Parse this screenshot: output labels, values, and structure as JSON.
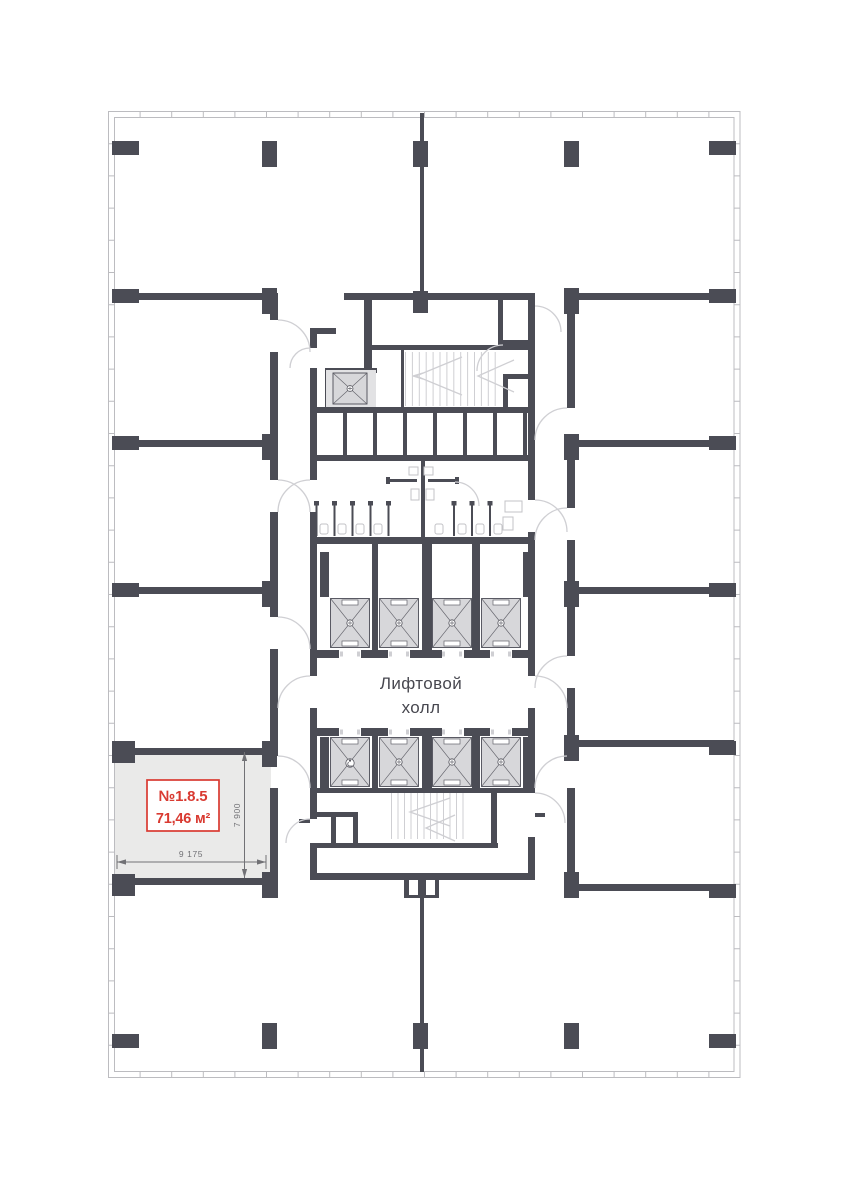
{
  "plan": {
    "elevator_hall": {
      "line1": "Лифтовой",
      "line2": "холл"
    },
    "unit": {
      "number": "№1.8.5",
      "area": "71,46 м²",
      "width_dim": "9 175",
      "height_dim": "7 900"
    }
  },
  "colors": {
    "wall": "#4b4c55",
    "fac": "#bcbcc0",
    "lt": "#cfcfd3",
    "elev": "#d7d7da",
    "esur": "#e2e2e4",
    "unit": "#eaeae9",
    "red": "#d93a31",
    "dim": "#717175",
    "txt": "#47474f"
  }
}
